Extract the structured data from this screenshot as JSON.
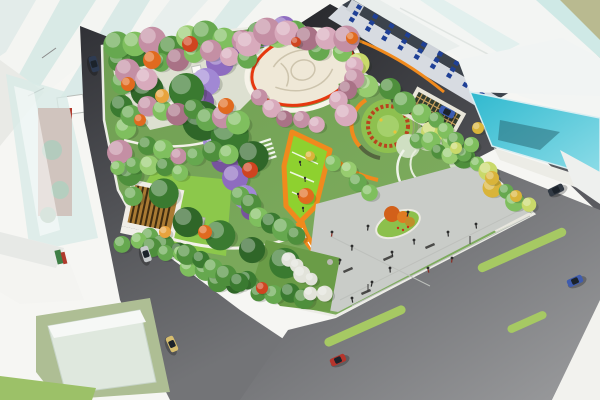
{
  "image": {
    "type": "architectural-aerial-rendering",
    "subject": "bird's-eye rendering of an urban pocket park with winding orange paths, wisteria tunnel, central cream plaza, pergolas, parking plaza, surrounding streets and glass buildings"
  },
  "palette": {
    "background": "#f6f6f3",
    "olive_field": "#b9ba90",
    "park_base": "#76a458",
    "park_pale_ground": "#e9e7df",
    "lawn_bright": "#8ed12f",
    "lawn_pergola": "#8cc84b",
    "plaza_paving": "#c9ccc8",
    "plaza_cream": "#efe8d7",
    "mural_line": "#cdc4ad",
    "path_orange": "#f08a1d",
    "ring_red": "#e6380f",
    "median_green": "#a6c963",
    "road_dark": "#38393d",
    "sidewalk": "#ecece6",
    "teal_glass": "#3fc3d5",
    "glass_pale": "#d9ebe7",
    "facade_gray": "#d7dbe1",
    "roof_dark": "#3c434c",
    "window_blue": "#1f4096",
    "sage_block": "#aebe94",
    "green_strip": "#9cc168",
    "pergola_wood": "#a97a33",
    "pergola_wood_dark": "#3f2c10",
    "trellis_pale": "#cfdfc2",
    "red_building": "#b23b2e"
  },
  "scene": {
    "tree_colors": [
      "#4e8f3c",
      "#66a84f",
      "#7fbf5e",
      "#97cc6f",
      "#3a7a30",
      "#2f6628",
      "#aed581",
      "#c9d96a",
      "#e8a33d",
      "#e06a1f",
      "#cf4420",
      "#d9b43a",
      "#c48fa4",
      "#d8aabc",
      "#a97286",
      "#8e6cc0",
      "#a188d4",
      "#77539e",
      "#e2e3da"
    ],
    "tree_bands": [
      {
        "f": [
          130,
          62
        ],
        "t": [
          252,
          158
        ],
        "n": 6,
        "r": [
          15,
          20
        ],
        "c": [
          4,
          5
        ],
        "s": 14
      },
      {
        "f": [
          160,
          200
        ],
        "t": [
          282,
          268
        ],
        "n": 5,
        "r": [
          13,
          17
        ],
        "c": [
          4,
          5
        ],
        "s": 12
      },
      {
        "f": [
          112,
          62
        ],
        "t": [
          134,
          196
        ],
        "n": 7,
        "r": [
          9,
          13
        ],
        "c": [
          0,
          1,
          4,
          2,
          12
        ],
        "s": 8
      },
      {
        "f": [
          148,
          240
        ],
        "t": [
          236,
          282
        ],
        "n": 7,
        "r": [
          8,
          12
        ],
        "c": [
          1,
          0,
          5,
          2
        ],
        "s": 9
      },
      {
        "f": [
          246,
          284
        ],
        "t": [
          302,
          304
        ],
        "n": 5,
        "r": [
          8,
          11
        ],
        "c": [
          4,
          0,
          1
        ],
        "s": 7
      },
      {
        "f": [
          118,
          52
        ],
        "t": [
          294,
          26
        ],
        "n": 11,
        "r": [
          9,
          14
        ],
        "c": [
          1,
          2,
          12,
          0,
          3
        ],
        "s": 8
      },
      {
        "f": [
          306,
          34
        ],
        "t": [
          466,
          154
        ],
        "n": 11,
        "r": [
          8,
          12
        ],
        "c": [
          0,
          1,
          2,
          7,
          3
        ],
        "s": 8
      },
      {
        "f": [
          474,
          168
        ],
        "t": [
          528,
          206
        ],
        "n": 6,
        "r": [
          7,
          10
        ],
        "c": [
          2,
          7,
          11,
          1
        ],
        "s": 7
      },
      {
        "f": [
          128,
          74
        ],
        "t": [
          246,
          52
        ],
        "n": 8,
        "r": [
          9,
          13
        ],
        "c": [
          12,
          13,
          1,
          14,
          2
        ],
        "s": 9
      },
      {
        "f": [
          132,
          108
        ],
        "t": [
          238,
          122
        ],
        "n": 8,
        "r": [
          9,
          12
        ],
        "c": [
          1,
          12,
          2,
          14,
          0
        ],
        "s": 9
      },
      {
        "f": [
          148,
          142
        ],
        "t": [
          228,
          158
        ],
        "n": 6,
        "r": [
          8,
          11
        ],
        "c": [
          0,
          2,
          12,
          1
        ],
        "s": 8
      },
      {
        "f": [
          248,
          40
        ],
        "t": [
          346,
          32
        ],
        "n": 6,
        "r": [
          10,
          14
        ],
        "c": [
          13,
          12,
          13,
          14
        ],
        "s": 7
      },
      {
        "f": [
          354,
          66
        ],
        "t": [
          342,
          114
        ],
        "n": 5,
        "r": [
          9,
          12
        ],
        "c": [
          13,
          12,
          14,
          13
        ],
        "s": 7
      },
      {
        "f": [
          258,
          100
        ],
        "t": [
          316,
          126
        ],
        "n": 5,
        "r": [
          8,
          11
        ],
        "c": [
          12,
          13,
          14
        ],
        "s": 7
      },
      {
        "f": [
          240,
          196
        ],
        "t": [
          296,
          236
        ],
        "n": 6,
        "r": [
          9,
          12
        ],
        "c": [
          1,
          0,
          2,
          4
        ],
        "s": 8
      },
      {
        "f": [
          334,
          162
        ],
        "t": [
          366,
          196
        ],
        "n": 4,
        "r": [
          8,
          10
        ],
        "c": [
          2,
          3,
          1
        ],
        "s": 7
      },
      {
        "f": [
          124,
          238
        ],
        "t": [
          180,
          256
        ],
        "n": 5,
        "r": [
          7,
          10
        ],
        "c": [
          1,
          2,
          0
        ],
        "s": 7
      },
      {
        "f": [
          188,
          252
        ],
        "t": [
          242,
          276
        ],
        "n": 5,
        "r": [
          8,
          11
        ],
        "c": [
          0,
          4,
          1
        ],
        "s": 7
      },
      {
        "f": [
          118,
          164
        ],
        "t": [
          180,
          172
        ],
        "n": 5,
        "r": [
          7,
          10
        ],
        "c": [
          2,
          1,
          3,
          0
        ],
        "s": 7
      },
      {
        "f": [
          420,
          136
        ],
        "t": [
          462,
          158
        ],
        "n": 5,
        "r": [
          7,
          10
        ],
        "c": [
          1,
          2,
          0,
          3
        ],
        "s": 7
      },
      {
        "f": [
          286,
          262
        ],
        "t": [
          320,
          298
        ],
        "n": 6,
        "r": [
          6,
          9
        ],
        "c": [
          18
        ],
        "s": 7
      },
      {
        "f": [
          438,
          118
        ],
        "t": [
          468,
          148
        ],
        "n": 4,
        "r": [
          7,
          9
        ],
        "c": [
          1,
          2
        ],
        "s": 6
      }
    ],
    "tree_singles": [
      [
        152,
        60,
        9,
        9
      ],
      [
        190,
        44,
        8,
        10
      ],
      [
        128,
        84,
        7,
        9
      ],
      [
        162,
        96,
        7,
        8
      ],
      [
        226,
        106,
        8,
        9
      ],
      [
        250,
        170,
        8,
        10
      ],
      [
        205,
        232,
        7,
        9
      ],
      [
        165,
        232,
        6,
        8
      ],
      [
        306,
        196,
        8,
        9
      ],
      [
        352,
        38,
        6,
        9
      ],
      [
        296,
        42,
        5,
        10
      ],
      [
        492,
        178,
        7,
        11
      ],
      [
        516,
        196,
        6,
        11
      ],
      [
        456,
        148,
        6,
        7
      ],
      [
        478,
        128,
        6,
        11
      ],
      [
        262,
        288,
        6,
        10
      ],
      [
        310,
        156,
        5,
        11
      ],
      [
        140,
        120,
        6,
        9
      ]
    ],
    "wisteria_tunnel": {
      "points": [
        [
          284,
          28,
          12
        ],
        [
          262,
          34,
          13
        ],
        [
          240,
          46,
          14
        ],
        [
          220,
          62,
          14
        ],
        [
          206,
          82,
          14
        ],
        [
          201,
          102,
          13
        ],
        [
          207,
          122,
          12
        ],
        [
          216,
          141,
          13
        ],
        [
          225,
          159,
          14
        ],
        [
          235,
          178,
          13
        ],
        [
          245,
          197,
          12
        ],
        [
          251,
          210,
          10
        ]
      ],
      "color_cycle": [
        15,
        16,
        17
      ]
    },
    "blue_building": {
      "floors": 3,
      "bays": 9,
      "angle": 30,
      "start": [
        342,
        18
      ],
      "end": [
        488,
        102
      ],
      "floor_step": 7.2
    },
    "medians": [
      [
        365,
        326,
        88,
        9,
        -24
      ],
      [
        522,
        250,
        96,
        9,
        -24
      ],
      [
        527,
        322,
        42,
        8,
        -24
      ]
    ],
    "cars": [
      [
        94,
        64,
        74,
        "#2e3b52"
      ],
      [
        146,
        254,
        72,
        "#c6cacc"
      ],
      [
        172,
        344,
        66,
        "#d6bd6e"
      ],
      [
        447,
        112,
        27,
        "#3a5bb0"
      ],
      [
        556,
        190,
        -26,
        "#323a44"
      ],
      [
        575,
        281,
        -24,
        "#3f5cae"
      ],
      [
        338,
        360,
        -24,
        "#b5352c"
      ]
    ],
    "plaza_people": [
      [
        332,
        232
      ],
      [
        352,
        246
      ],
      [
        368,
        226
      ],
      [
        392,
        252
      ],
      [
        414,
        240
      ],
      [
        428,
        268
      ],
      [
        448,
        232
      ],
      [
        372,
        282
      ],
      [
        352,
        298
      ],
      [
        408,
        212
      ],
      [
        452,
        258
      ],
      [
        476,
        224
      ],
      [
        390,
        268
      ],
      [
        340,
        260
      ]
    ],
    "lawn_people": [
      [
        300,
        162
      ],
      [
        305,
        178
      ],
      [
        298,
        194
      ],
      [
        303,
        208
      ]
    ],
    "benches": [
      [
        348,
        270,
        -24
      ],
      [
        388,
        258,
        -24
      ],
      [
        430,
        246,
        -24
      ],
      [
        366,
        292,
        -24
      ]
    ]
  }
}
